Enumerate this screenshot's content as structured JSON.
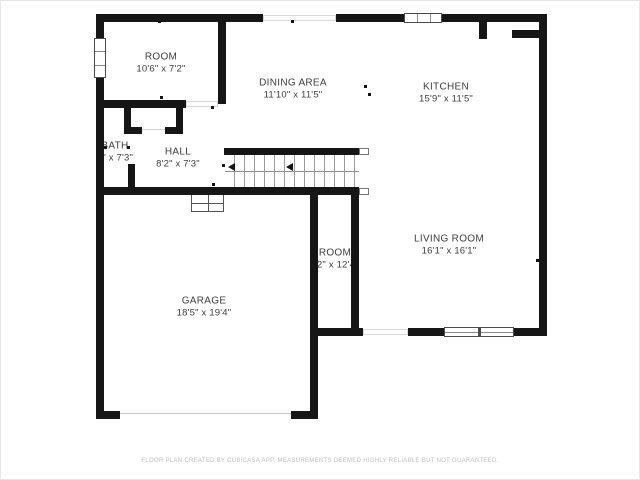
{
  "plan": {
    "rooms": [
      {
        "name": "ROOM",
        "dims": "10'6\" x 7'2\""
      },
      {
        "name": "DINING AREA",
        "dims": "11'10\" x 11'5\""
      },
      {
        "name": "KITCHEN",
        "dims": "15'9\" x 11'5\""
      },
      {
        "name": "BATH",
        "dims": "5\" x 7'3\""
      },
      {
        "name": "HALL",
        "dims": "8'2\" x 7'3\""
      },
      {
        "name": "ROOM",
        "dims": "'2\" x 12'4"
      },
      {
        "name": "LIVING ROOM",
        "dims": "16'1\" x 16'1\""
      },
      {
        "name": "GARAGE",
        "dims": "18'5\" x 19'4\""
      }
    ],
    "footer": "FLOOR PLAN CREATED BY CUBICASA APP. MEASUREMENTS DEEMED HIGHLY RELIABLE BUT NOT GUARANTEED.",
    "colors": {
      "wall": "#161616",
      "text": "#3c3c3c",
      "footer": "#bdbdbd"
    }
  }
}
